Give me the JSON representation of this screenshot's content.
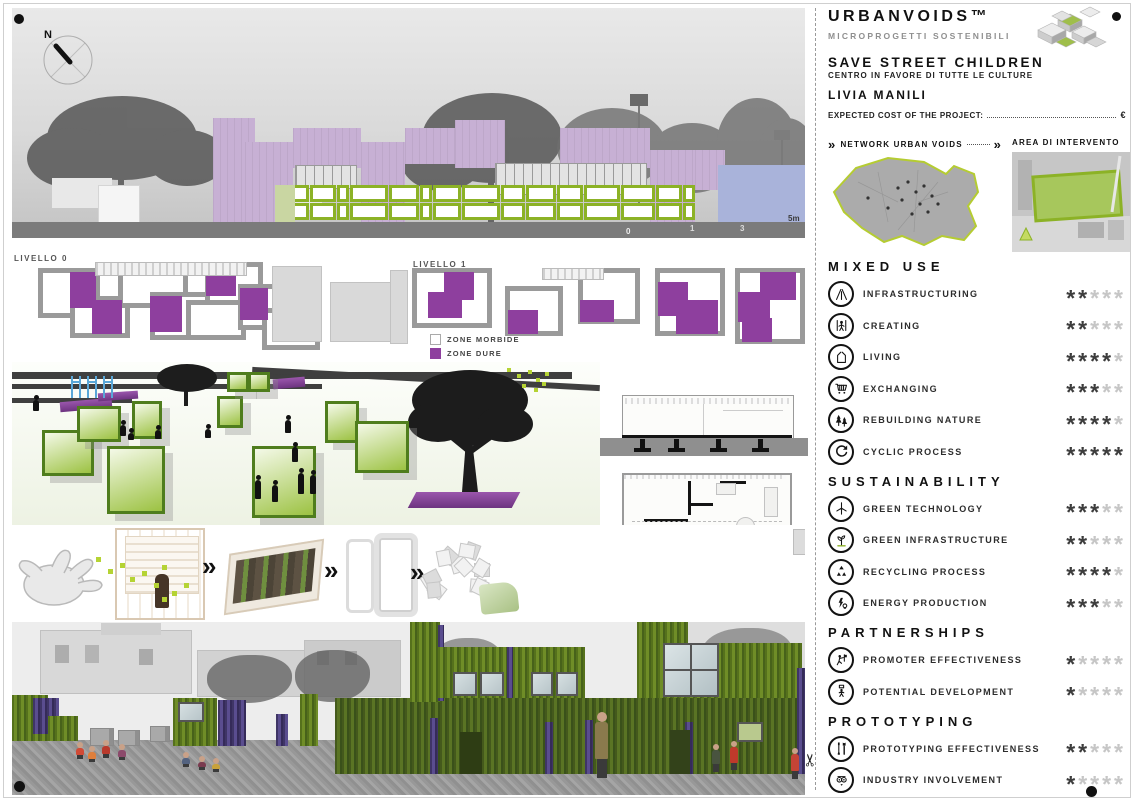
{
  "board": {
    "compass_label": "N",
    "elevation_scale": {
      "zero": "0",
      "one": "1",
      "three": "3",
      "five": "5m"
    },
    "detail_scale": {
      "zero": "0",
      "one": "1",
      "three": "3",
      "five": "5m"
    },
    "plans": {
      "level0": "LIVELLO 0",
      "level1": "LIVELLO 1",
      "legend": [
        {
          "label": "ZONE MORBIDE",
          "swatch": "#ffffff"
        },
        {
          "label": "ZONE DURE",
          "swatch": "#8e3f9e"
        }
      ]
    },
    "process": {
      "arrow_char": "»"
    },
    "cutline": {
      "scissors_char": "✂"
    }
  },
  "sidebar": {
    "brand": {
      "title": "URBANVOIDS™",
      "subtitle": "MICROPROGETTI SOSTENIBILI"
    },
    "project": {
      "title": "SAVE STREET CHILDREN",
      "subtitle": "CENTRO IN FAVORE DI TUTTE LE CULTURE",
      "author": "LIVIA MANILI",
      "cost_label": "EXPECTED COST OF THE PROJECT:",
      "cost_currency": "€"
    },
    "maps": {
      "chevron": "»",
      "left_label": "NETWORK URBAN VOIDS",
      "right_label": "AREA DI INTERVENTO"
    },
    "ratings": {
      "max_stars": 5,
      "star_char": "*",
      "star_filled_color": "#3d3d3d",
      "star_empty_color": "#c6c6c6",
      "sections": [
        {
          "title": "MIXED USE",
          "items": [
            {
              "icon": "road-icon",
              "label": "INFRASTRUCTURING",
              "stars": 2
            },
            {
              "icon": "builder-icon",
              "label": "CREATING",
              "stars": 2
            },
            {
              "icon": "house-module-icon",
              "label": "LIVING",
              "stars": 4
            },
            {
              "icon": "shopping-cart-icon",
              "label": "EXCHANGING",
              "stars": 3
            },
            {
              "icon": "trees-icon",
              "label": "REBUILDING NATURE",
              "stars": 4
            },
            {
              "icon": "cyclic-arrow-icon",
              "label": "CYCLIC PROCESS",
              "stars": 5
            }
          ]
        },
        {
          "title": "SUSTAINABILITY",
          "items": [
            {
              "icon": "wind-turbine-icon",
              "label": "GREEN TECHNOLOGY",
              "stars": 3
            },
            {
              "icon": "sprout-icon",
              "label": "GREEN INFRASTRUCTURE",
              "stars": 2
            },
            {
              "icon": "recycle-icon",
              "label": "RECYCLING PROCESS",
              "stars": 4
            },
            {
              "icon": "energy-bulb-icon",
              "label": "ENERGY PRODUCTION",
              "stars": 3
            }
          ]
        },
        {
          "title": "PARTNERSHIPS",
          "items": [
            {
              "icon": "promoter-icon",
              "label": "PROMOTER EFFECTIVENESS",
              "stars": 1
            },
            {
              "icon": "development-icon",
              "label": "POTENTIAL DEVELOPMENT",
              "stars": 1
            }
          ]
        },
        {
          "title": "PROTOTYPING",
          "items": [
            {
              "icon": "tools-icon",
              "label": "PROTOTYPING EFFECTIVENESS",
              "stars": 2
            },
            {
              "icon": "industry-icon",
              "label": "INDUSTRY INVOLVEMENT",
              "stars": 1
            }
          ]
        }
      ]
    }
  },
  "colors": {
    "accent_green": "#8cb226",
    "accent_purple": "#8e3f9e",
    "elevation_purple": "#c7b0d4",
    "elevation_blue": "#a9b3da",
    "lime": "#b5d334"
  }
}
